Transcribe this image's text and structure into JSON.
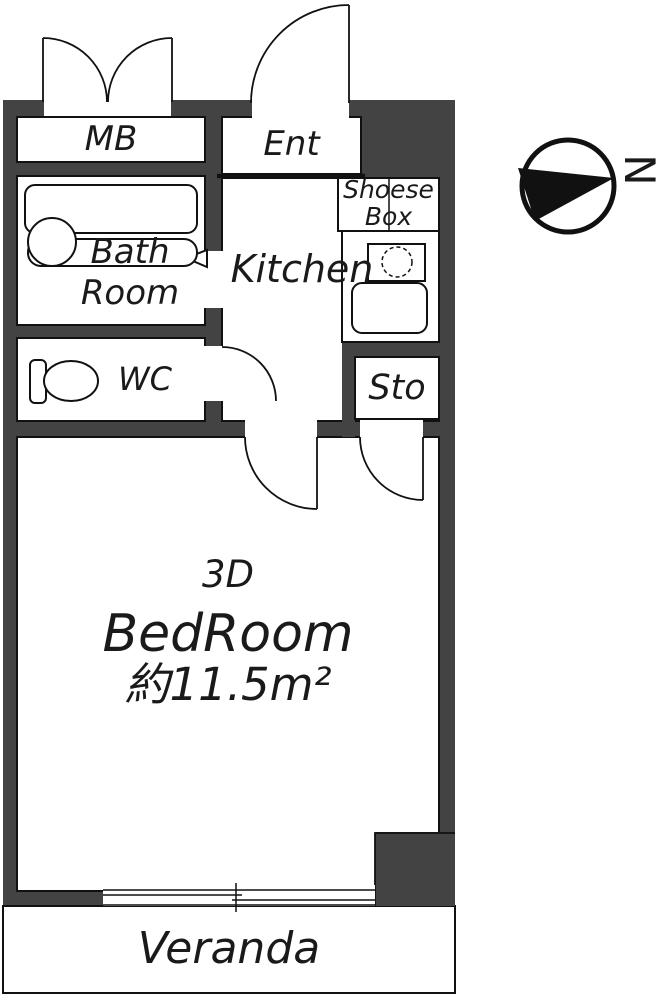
{
  "rooms": {
    "mb": {
      "label": "MB"
    },
    "ent": {
      "label": "Ent"
    },
    "shoes_box": {
      "line1": "Shoese",
      "line2": "Box"
    },
    "kitchen": {
      "label": "Kitchen"
    },
    "sto": {
      "label": "Sto"
    },
    "bath_room": {
      "line1": "Bath",
      "line2": "Room"
    },
    "wc": {
      "label": "WC"
    },
    "bedroom": {
      "type_label": "3D",
      "name": "BedRoom",
      "area": "約11.5m²"
    },
    "veranda": {
      "label": "Veranda"
    }
  },
  "compass": {
    "north_label": "N"
  },
  "colors": {
    "wall": "#434343",
    "line": "#111111",
    "text": "#1a1a1a",
    "background": "#ffffff"
  }
}
